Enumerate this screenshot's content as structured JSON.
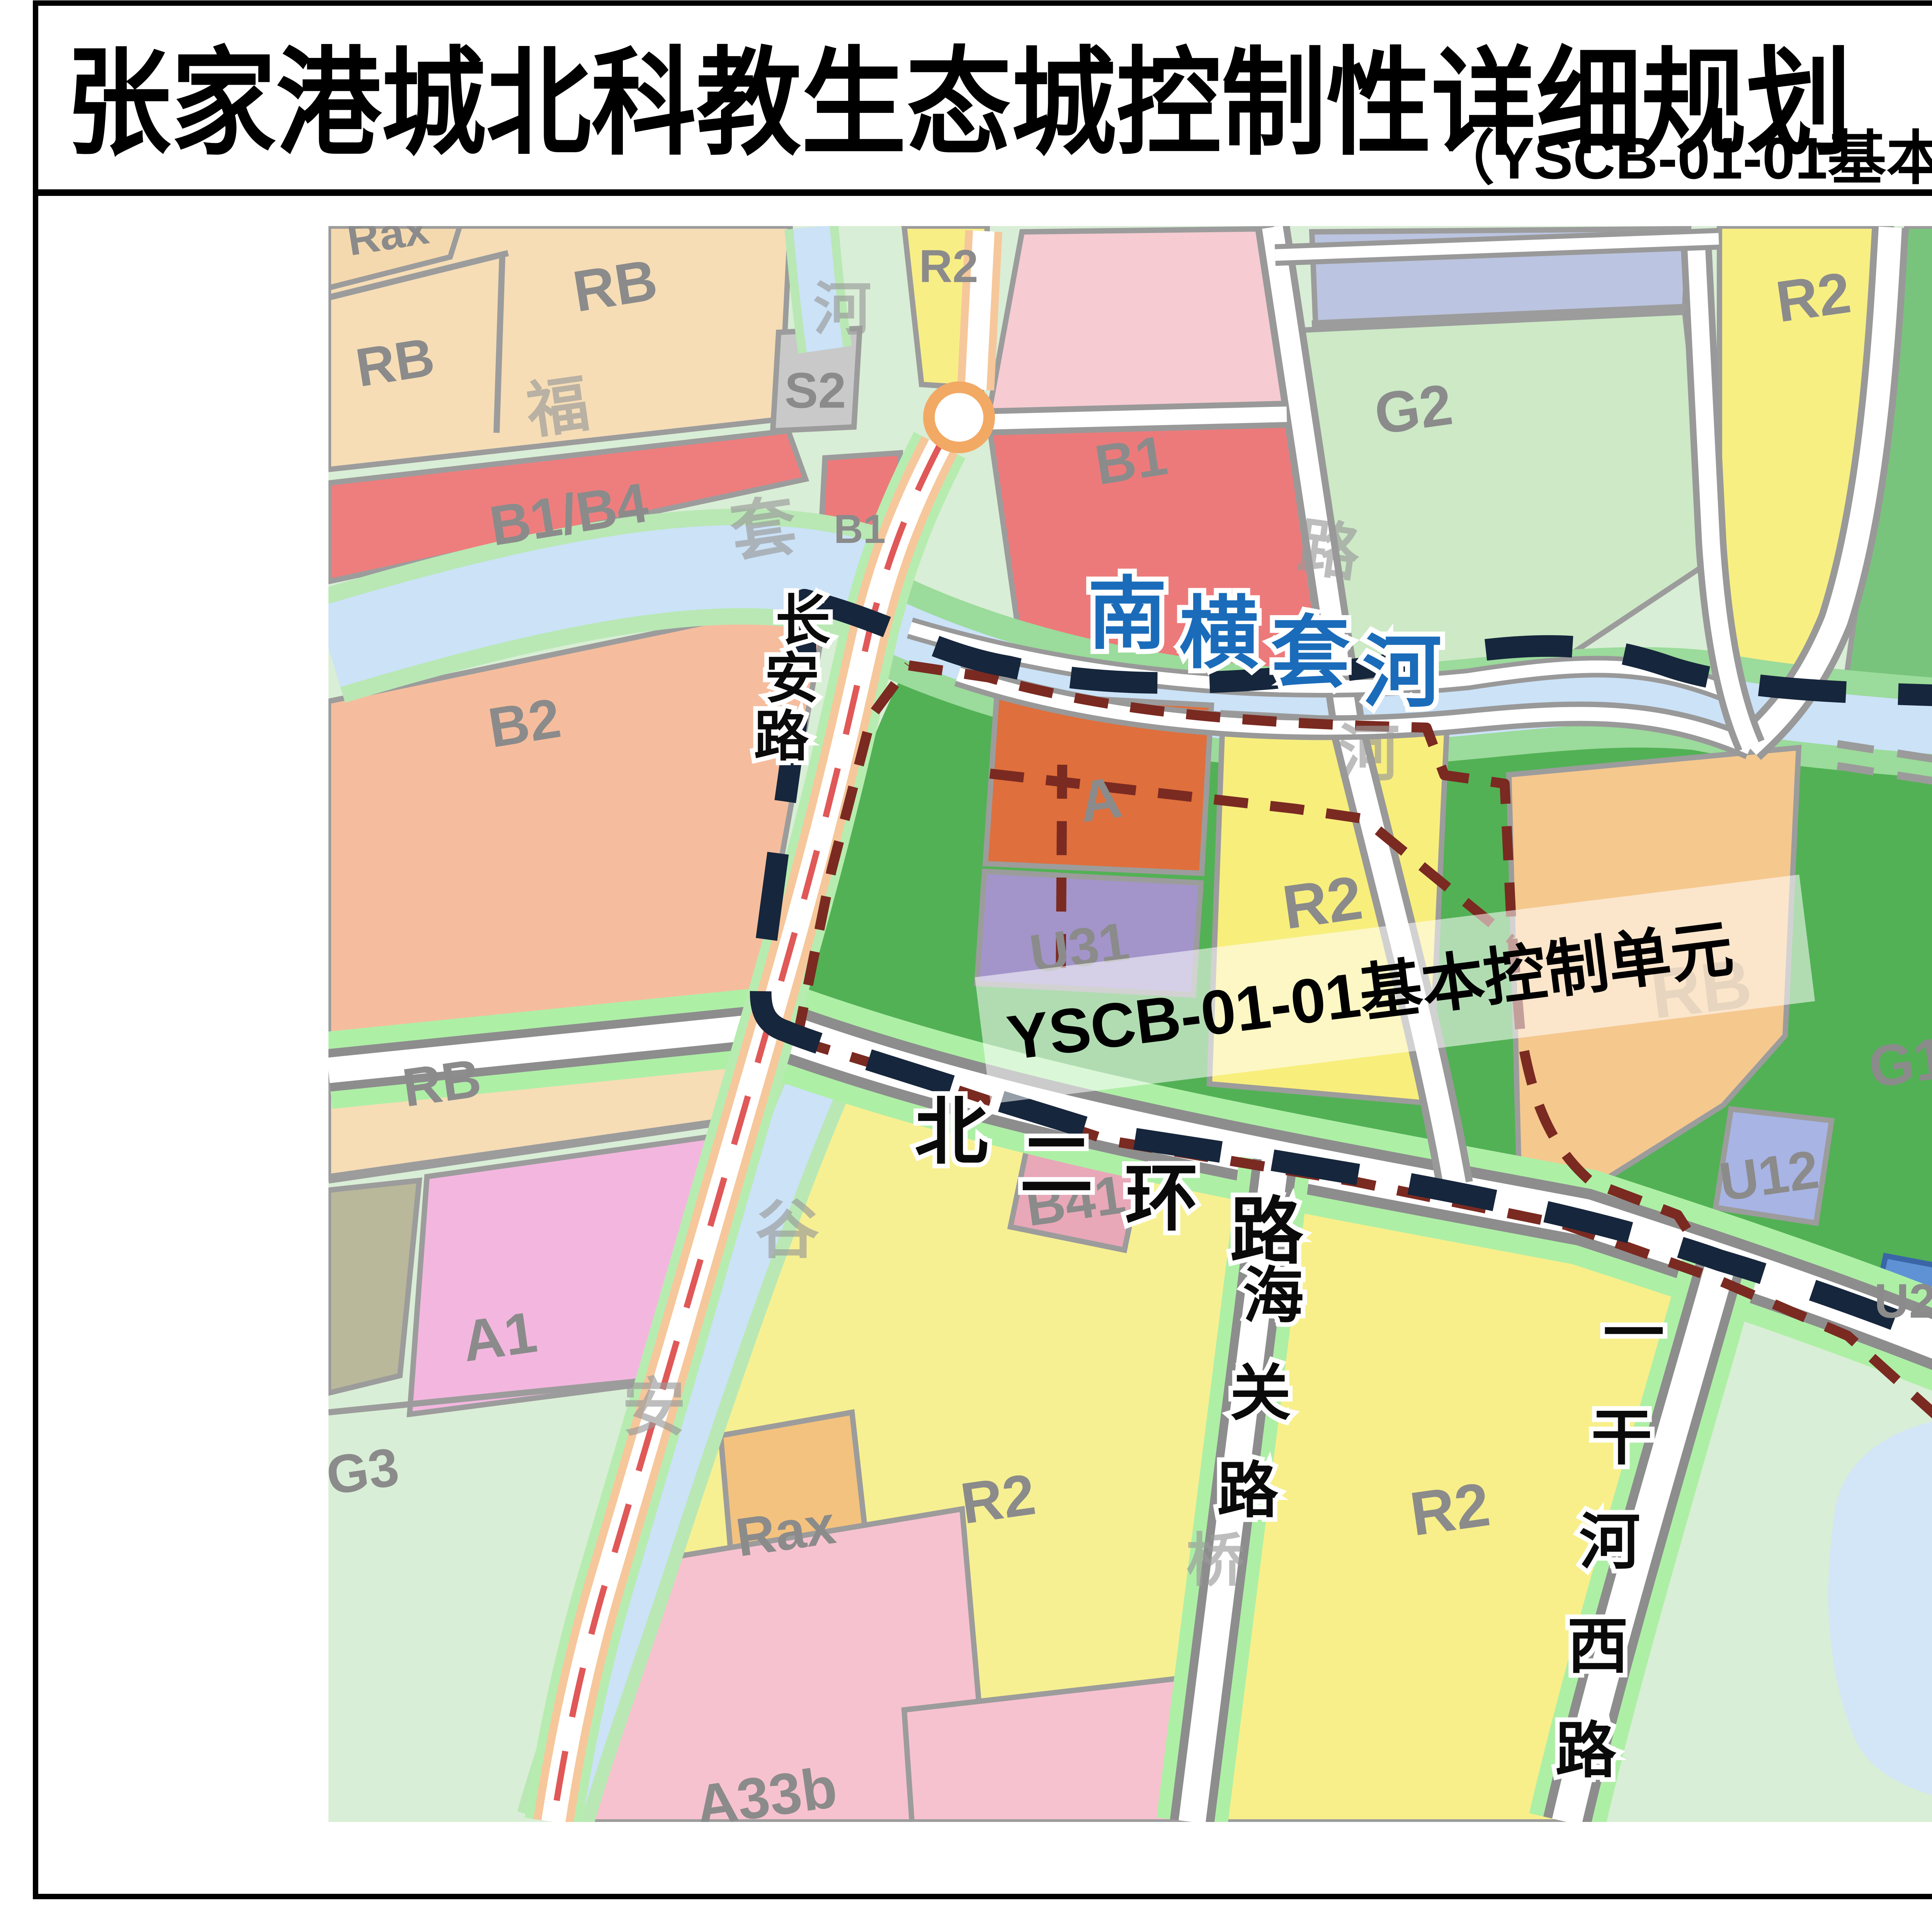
{
  "page": {
    "title": "张家港城北科教生态城控制性详细规划",
    "subtitle": "（YSCB-01-01基本控制单元） 拟调整范围图"
  },
  "map": {
    "unit_label": "YSCB-01-01基本控制单元",
    "rivers": {
      "nanhengtao": "南横套河",
      "yiganhe": "一干河"
    },
    "roads": {
      "changan": "长安路",
      "beierhuan": "北二环路",
      "haiguan": "海关路",
      "yiganhexi": "一干河西路"
    },
    "parcels": [
      {
        "code": "Rax"
      },
      {
        "code": "RB"
      },
      {
        "code": "RB"
      },
      {
        "code": "B1/B4"
      },
      {
        "code": "B2"
      },
      {
        "code": "S2"
      },
      {
        "code": "R2"
      },
      {
        "code": "B1"
      },
      {
        "code": "B1"
      },
      {
        "code": "G2"
      },
      {
        "code": "R2"
      },
      {
        "code": "G1a"
      },
      {
        "code": "B"
      },
      {
        "code": "A"
      },
      {
        "code": "U31"
      },
      {
        "code": "R2"
      },
      {
        "code": "RB"
      },
      {
        "code": "G1a"
      },
      {
        "code": "U12"
      },
      {
        "code": "U21"
      },
      {
        "code": "U11"
      },
      {
        "code": "A9"
      },
      {
        "code": "RB"
      },
      {
        "code": "A1"
      },
      {
        "code": "G3"
      },
      {
        "code": "R2"
      },
      {
        "code": "Rax"
      },
      {
        "code": "A33b"
      },
      {
        "code": "B41"
      },
      {
        "code": "R2"
      },
      {
        "code": "A3"
      }
    ],
    "ghosts": [
      "套",
      "河",
      "福",
      "路",
      "河",
      "河",
      "河",
      "谷",
      "安",
      "桥",
      "一"
    ],
    "colors": {
      "unit_boundary": "#16263c",
      "adjust_boundary": "#7a2a21",
      "water": "#cbe2f7",
      "green_center": "#52b155"
    }
  }
}
